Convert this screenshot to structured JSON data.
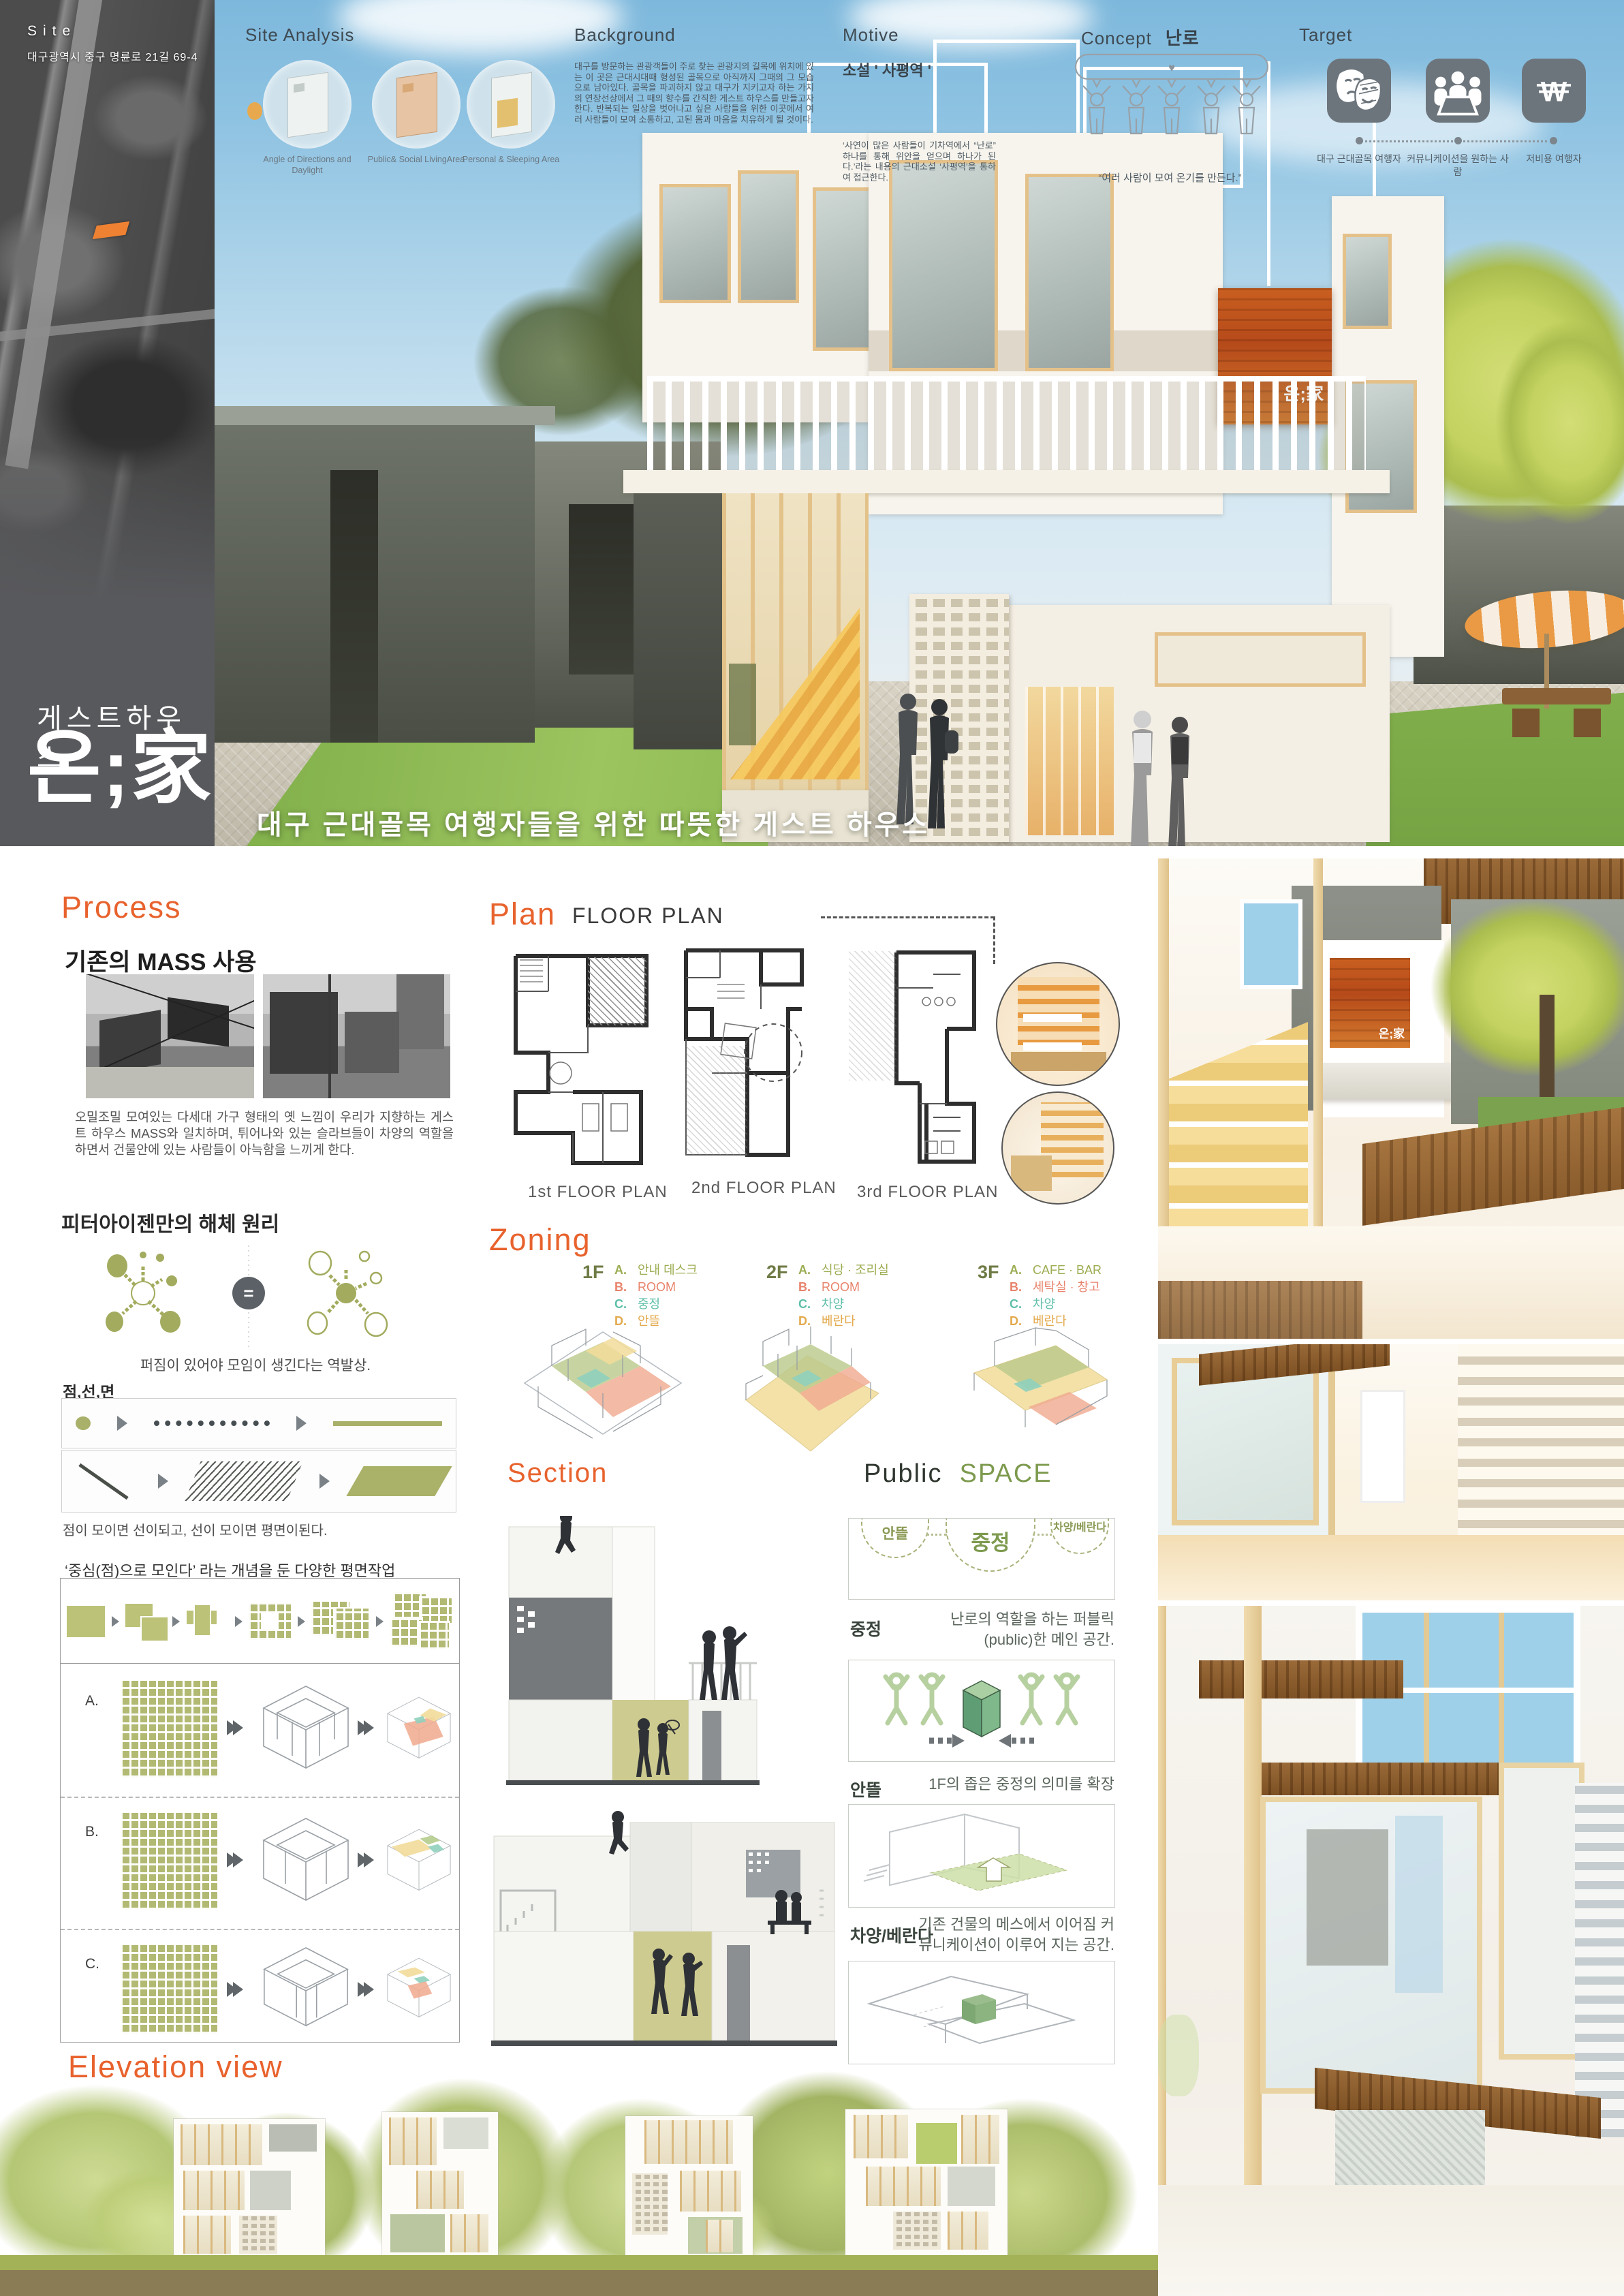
{
  "palette": {
    "accent_orange": "#e8622d",
    "marker_orange": "#ef8232",
    "olive": "#aab168",
    "teal": "#5fbfa9",
    "salmon": "#e8836b",
    "amber": "#e3a94c",
    "sidebar_gray": "#58595c",
    "sky_blue": "#8fc3e2",
    "sign_wood": "#c35a1e"
  },
  "sidebar": {
    "site_label": "Site",
    "address": "대구광역시 중구 명륜로 21길 69-4",
    "category": "게스트하우스",
    "brand": "온;家"
  },
  "hero": {
    "site_analysis": {
      "title": "Site Analysis",
      "circles": [
        {
          "label": "Angle of Directions and Daylight"
        },
        {
          "label": "Public& Social LivingArea"
        },
        {
          "label": "Personal & Sleeping Area"
        }
      ]
    },
    "background": {
      "title": "Background",
      "body": "대구를 방문하는 관광객들이 주로 찾는 관광지의 길목에 위치에 있는 이 곳은 근대시대때 형성된 골목으로 아직까지 그때의 그 모습으로 남아있다. 골목을 파괴하지 않고 대구가 지키고자 하는 가치의 연장선상에서 그 때의 향수를 간직한 게스트 하우스를 만들고자 한다. 반복되는 일상을 벗어나고 싶은 사람들을 위한  이곳에서 여러 사람들이 모여 소통하고, 고된 몸과 마음을 치유하게 될 것이다."
    },
    "motive": {
      "title": "Motive",
      "subtitle": "소설 ' 사평역 '",
      "body": "‘사연이 많은 사람들이 기차역에서 “난로” 하나를 통해 위안을 얻으며 하나가 된다.’라는 내용의 근대소설 ‘사평역’을 통하여 접근한다."
    },
    "concept": {
      "title": "Concept",
      "keyword": "난로",
      "caption": "“여러 사람이 모여 온기를 만든다.”"
    },
    "target": {
      "title": "Target",
      "items": [
        {
          "icon": "theater-masks-icon",
          "label": "대구 근대골목 여행자"
        },
        {
          "icon": "meeting-table-icon",
          "label": "커뮤니케이션을 원하는 사람"
        },
        {
          "icon": "won-currency-icon",
          "label": "저비용 여행자"
        }
      ]
    },
    "building_sign": "온;家",
    "tagline": "대구 근대골목 여행자들을 위한 따뜻한 게스트 하우스"
  },
  "process": {
    "title": "Process",
    "subtitle": "기존의 MASS 사용",
    "body": "오밀조밀 모여있는 다세대 가구 형태의 옛 느낌이 우리가 지향하는 게스트 하우스 MASS와 일치하며, 튀어나와 있는 슬라브들이 차양의 역할을 하면서 건물안에 있는 사람들이 아늑함을 느끼게 한다."
  },
  "eisenman": {
    "title": "피터아이젠만의 해체 원리",
    "caption": "퍼짐이 있어야 모임이 생긴다는 역발상.",
    "plp_label": "점,선,면",
    "plp_caption": "점이 모이면 선이되고, 선이 모이면 평면이된다."
  },
  "concept_plan": {
    "title": "‘중심(점)으로 모인다’ 라는 개념을 둔 다양한 평면작업",
    "rows": [
      "A.",
      "B.",
      "C."
    ]
  },
  "elevation": {
    "title": "Elevation view"
  },
  "plan": {
    "title": "Plan",
    "subtitle": "FLOOR PLAN",
    "floor_labels": [
      "1st FLOOR PLAN",
      "2nd FLOOR PLAN",
      "3rd FLOOR PLAN"
    ]
  },
  "zoning": {
    "title": "Zoning",
    "floors": [
      {
        "name": "1F",
        "items": [
          {
            "key": "A.",
            "label": "안내 데스크"
          },
          {
            "key": "B.",
            "label": "ROOM"
          },
          {
            "key": "C.",
            "label": "중정"
          },
          {
            "key": "D.",
            "label": "안뜰"
          }
        ]
      },
      {
        "name": "2F",
        "items": [
          {
            "key": "A.",
            "label": "식당 · 조리실"
          },
          {
            "key": "B.",
            "label": "ROOM"
          },
          {
            "key": "C.",
            "label": "차양"
          },
          {
            "key": "D.",
            "label": "베란다"
          }
        ]
      },
      {
        "name": "3F",
        "items": [
          {
            "key": "A.",
            "label": "CAFE · BAR"
          },
          {
            "key": "B.",
            "label": "세탁실 · 창고"
          },
          {
            "key": "C.",
            "label": "차양"
          },
          {
            "key": "D.",
            "label": "베란다"
          }
        ]
      }
    ]
  },
  "section": {
    "title": "Section"
  },
  "public_space": {
    "title_main": "Public",
    "title_accent": "SPACE",
    "bubbles": [
      "안뜰",
      "중정",
      "차양/베란다"
    ],
    "entries": [
      {
        "label": "중정",
        "desc": "난로의 역할을 하는 퍼블릭(public)한 메인 공간."
      },
      {
        "label": "안뜰",
        "desc": "1F의 좁은 중정의 의미를 확장"
      },
      {
        "label": "차양/베란다",
        "desc": "기존 건물의 메스에서 이어짐 커뮤니케이션이 이루어 지는 공간."
      }
    ]
  },
  "interior": {
    "sign": "온;家"
  }
}
